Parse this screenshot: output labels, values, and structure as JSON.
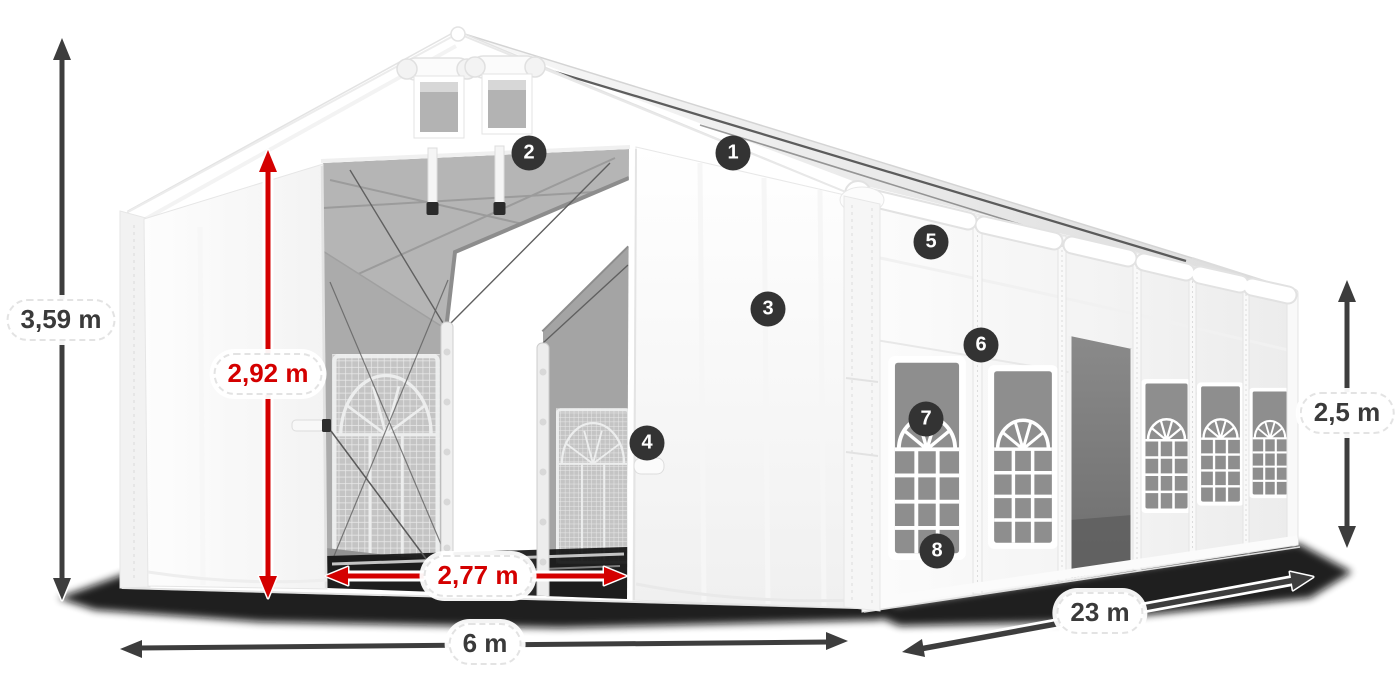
{
  "colors": {
    "accent_red": "#d40000",
    "arrow_dark": "#3d3d3d",
    "badge_background": "#333333",
    "tent_white": "#ffffff"
  },
  "dimensions": {
    "total_height": {
      "label": "3,59 m",
      "color": "#3d3d3d"
    },
    "entrance_height": {
      "label": "2,92 m",
      "color": "#d40000"
    },
    "entrance_width": {
      "label": "2,77 m",
      "color": "#d40000"
    },
    "tent_width": {
      "label": "6 m",
      "color": "#3d3d3d"
    },
    "tent_length": {
      "label": "23 m",
      "color": "#3d3d3d"
    },
    "side_height": {
      "label": "2,5 m",
      "color": "#3d3d3d"
    }
  },
  "callouts": [
    {
      "label": "1"
    },
    {
      "label": "2"
    },
    {
      "label": "3"
    },
    {
      "label": "4"
    },
    {
      "label": "5"
    },
    {
      "label": "6"
    },
    {
      "label": "7"
    },
    {
      "label": "8"
    }
  ]
}
